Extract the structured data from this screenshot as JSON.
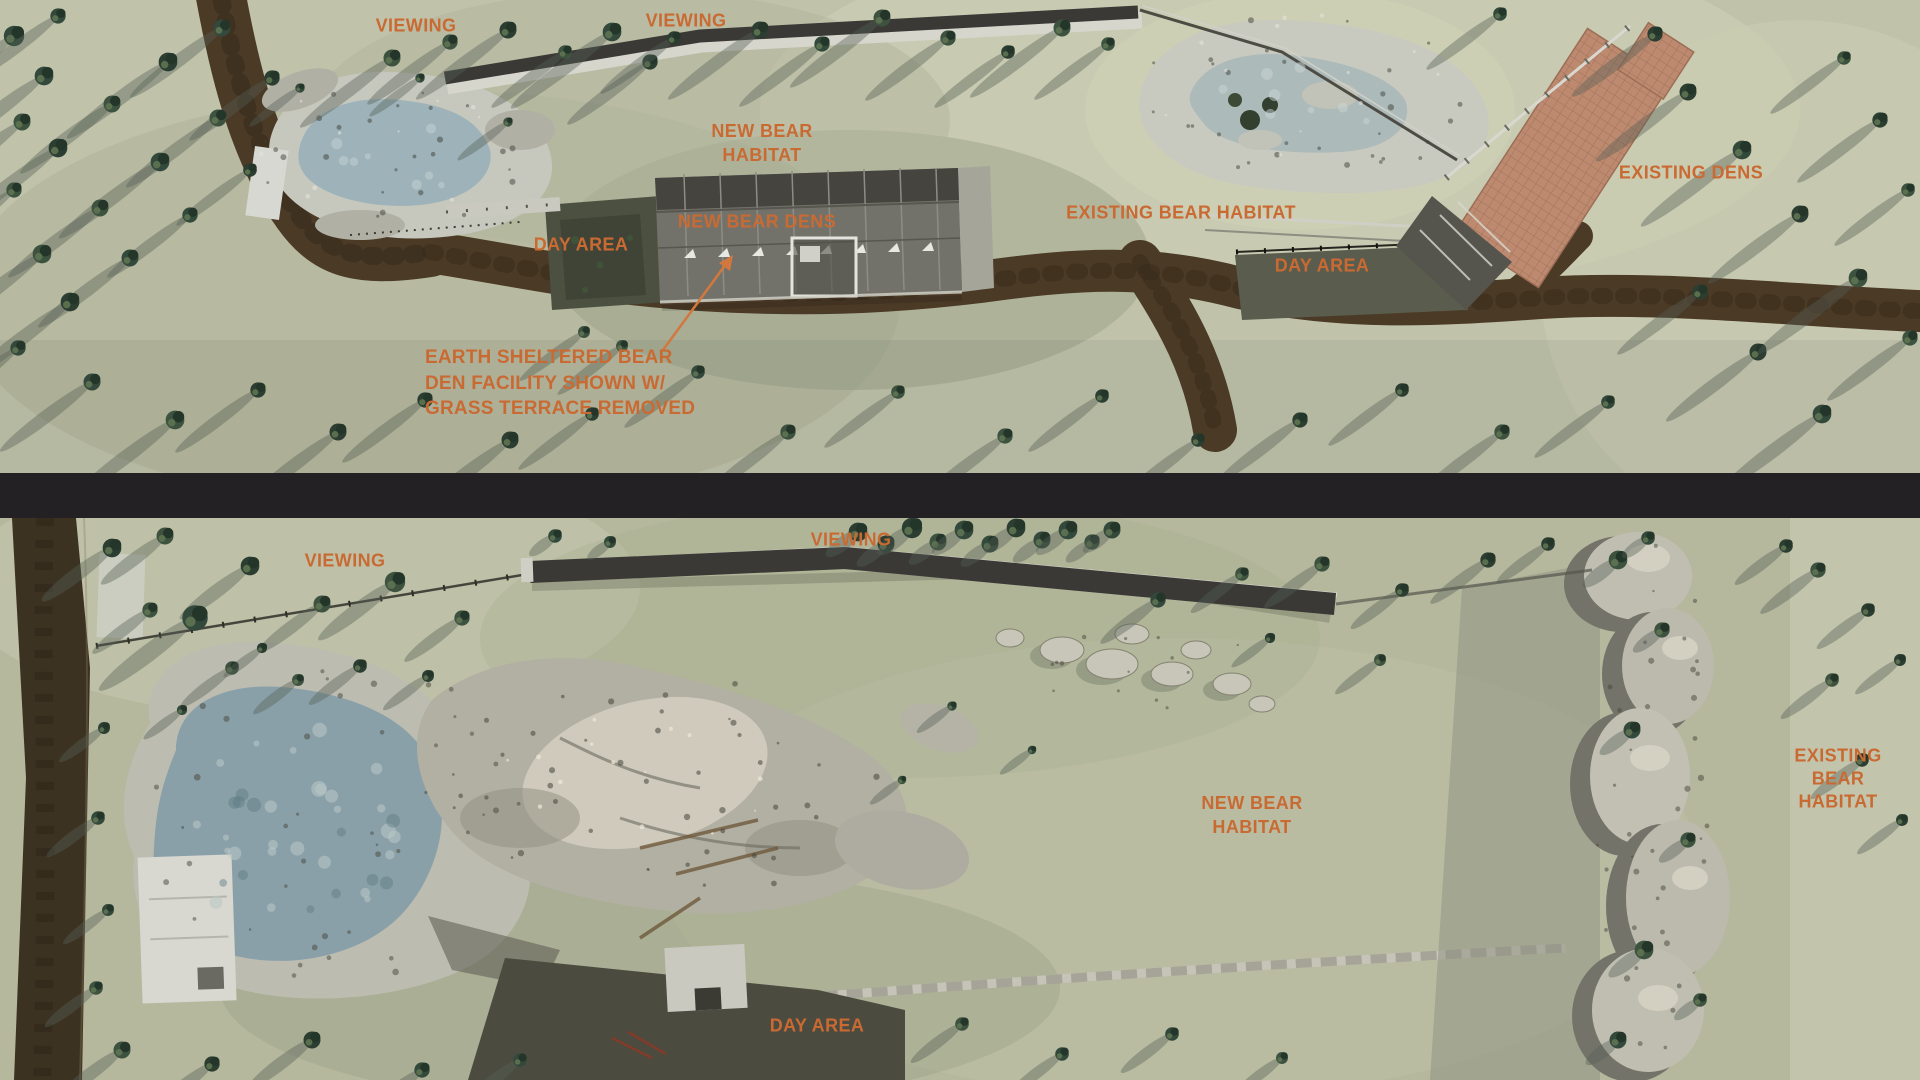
{
  "colors": {
    "label": "#ca6a33",
    "arrow": "#d2783f",
    "divider": "#242124"
  },
  "top": {
    "viewing_left": "VIEWING",
    "viewing_center": "VIEWING",
    "new_bear_habitat": "NEW BEAR\nHABITAT",
    "new_bear_dens": "NEW BEAR DENS",
    "day_area_left": "DAY AREA",
    "existing_bear_habitat": "EXISTING BEAR HABITAT",
    "day_area_right": "DAY AREA",
    "existing_dens": "EXISTING DENS",
    "annotation": "EARTH SHELTERED BEAR\nDEN FACILITY SHOWN W/\nGRASS TERRACE REMOVED"
  },
  "bottom": {
    "viewing_left": "VIEWING",
    "viewing_center": "VIEWING",
    "new_bear_habitat": "NEW BEAR\nHABITAT",
    "existing_bear_habitat": "EXISTING BEAR\nHABITAT",
    "day_area": "DAY AREA"
  }
}
